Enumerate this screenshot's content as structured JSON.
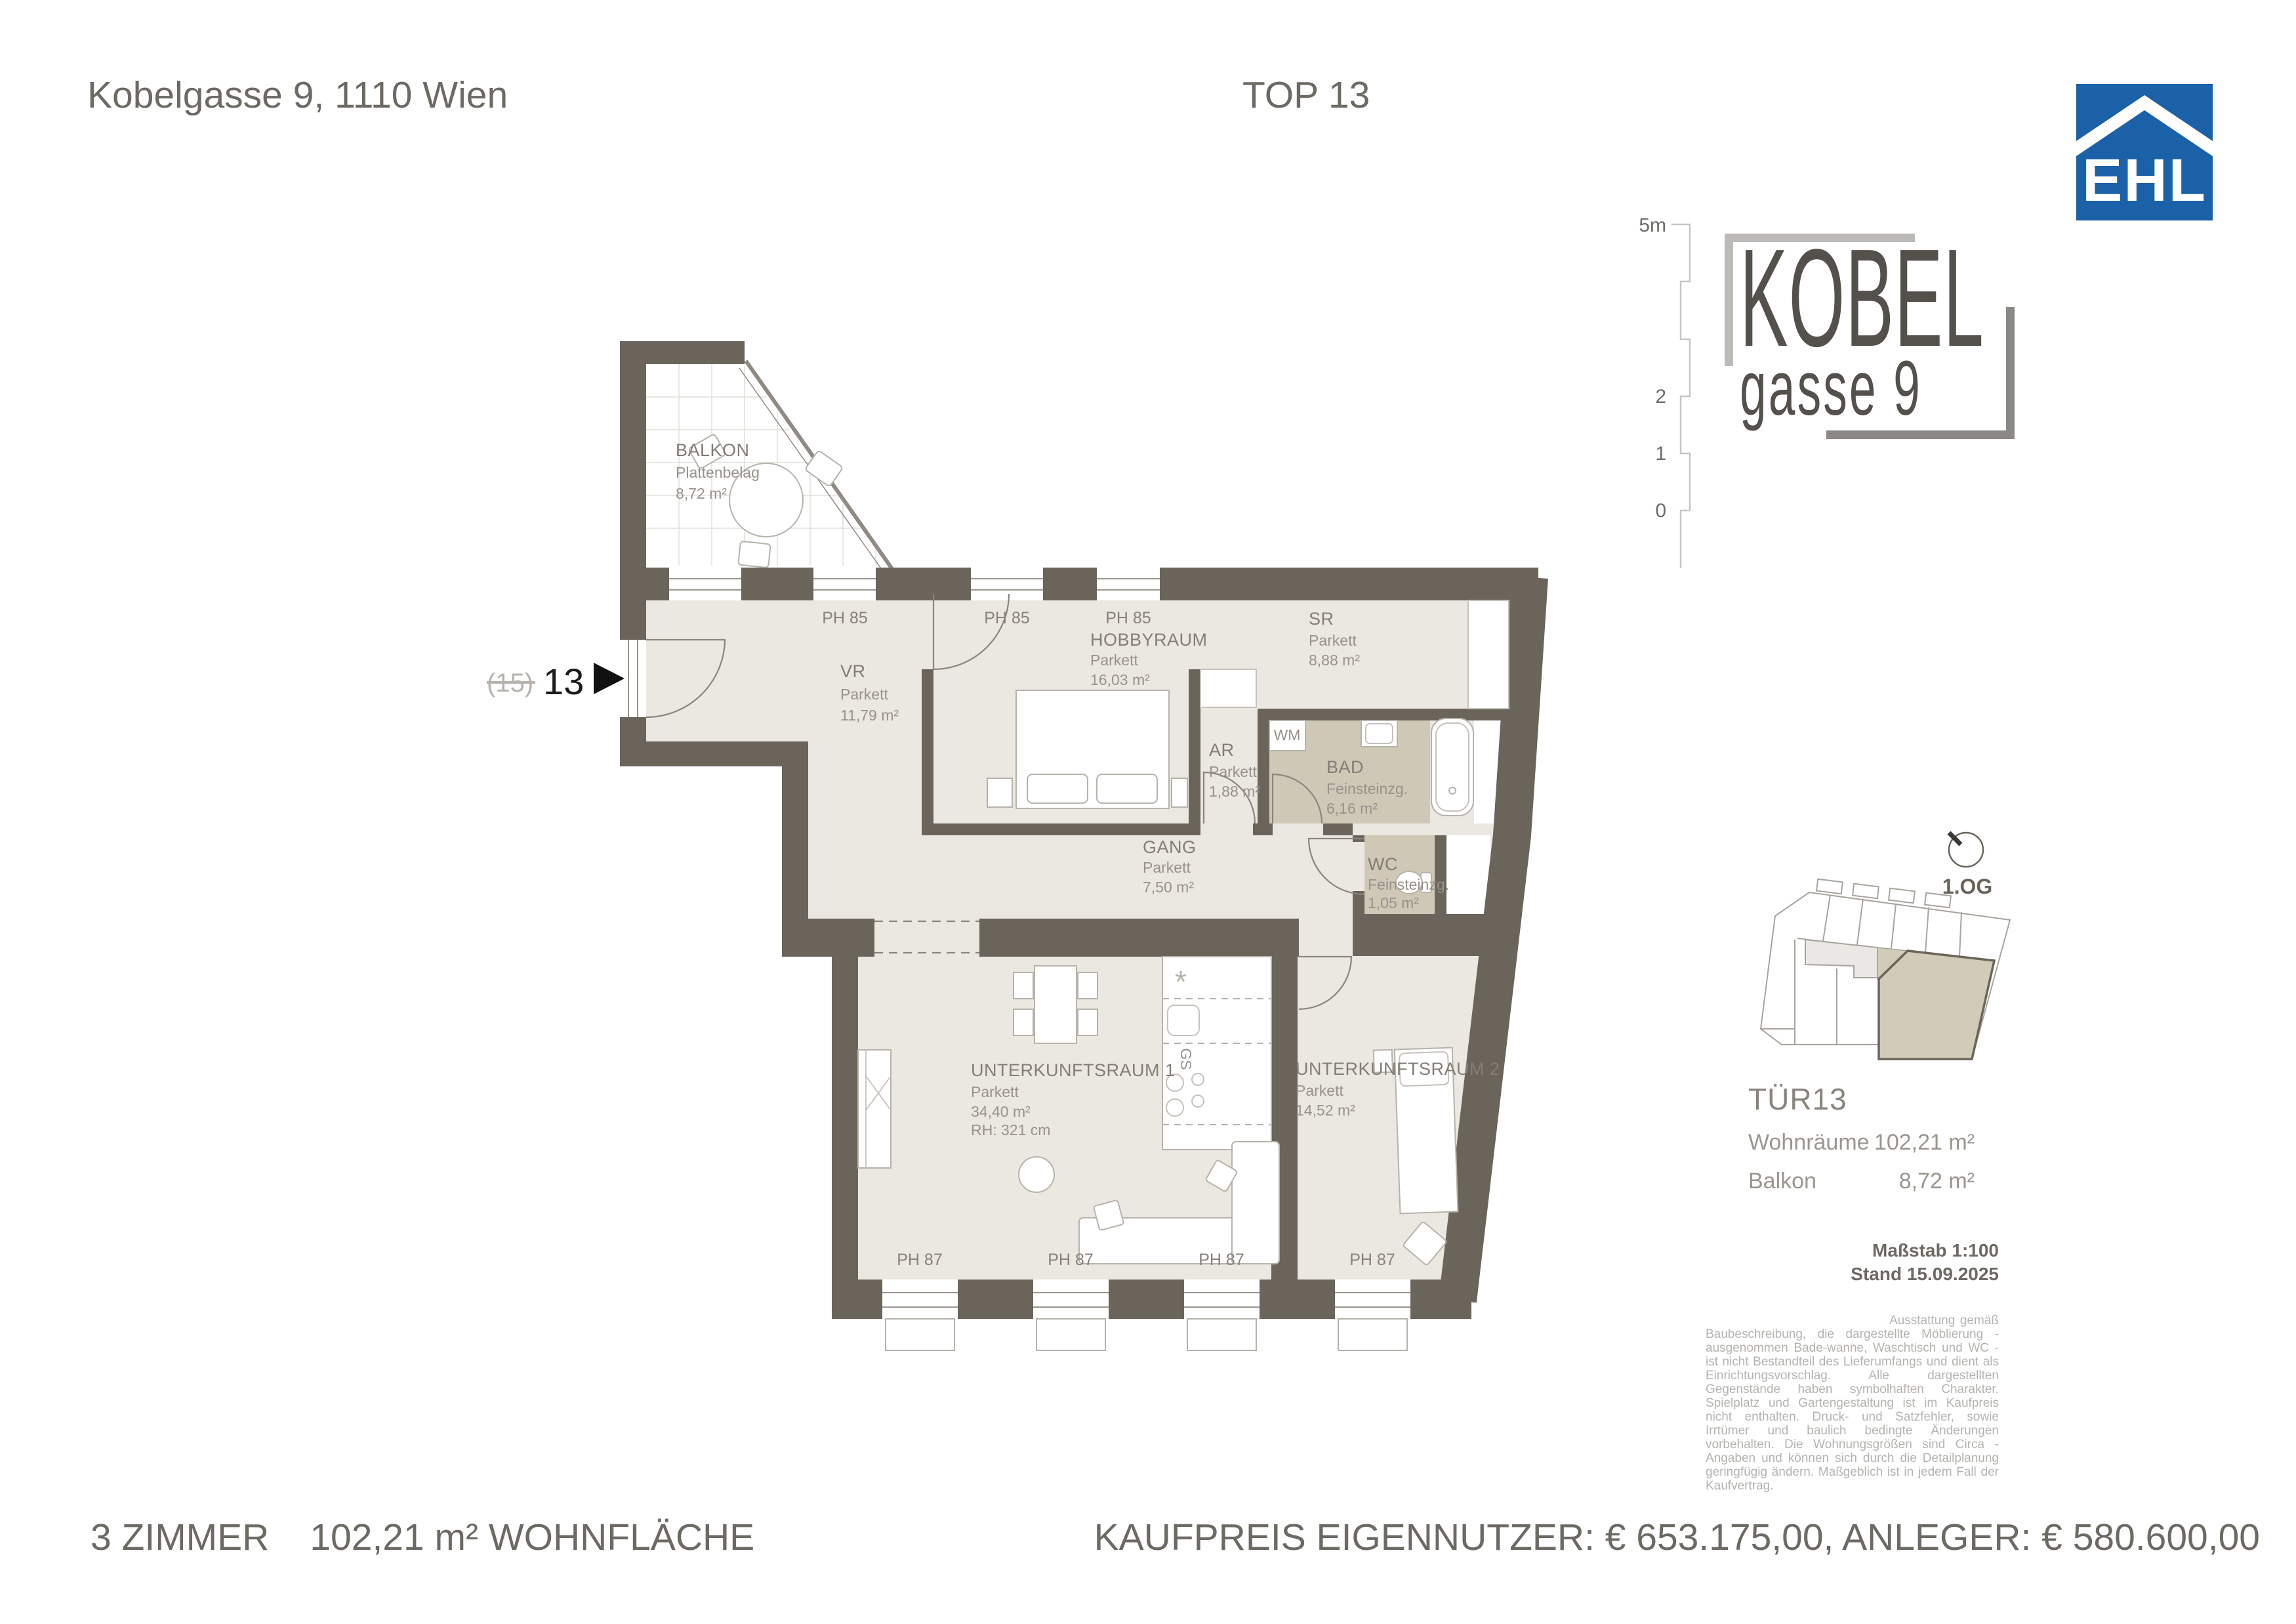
{
  "header": {
    "address": "Kobelgasse 9, 1110 Wien",
    "unit": "TOP 13"
  },
  "logo_ehl": {
    "text": "EHL",
    "blue": "#1b61a8"
  },
  "logo_kobel": {
    "line1": "KOBEL",
    "line2": "gasse 9"
  },
  "scalebar": {
    "top_label": "5m",
    "mid_labels": [
      "2",
      "1",
      "0"
    ]
  },
  "entrance": {
    "previous": "(15)",
    "current": "13"
  },
  "rooms": {
    "balkon": {
      "name": "BALKON",
      "finish": "Plattenbelag",
      "area": "8,72 m²"
    },
    "vr": {
      "name": "VR",
      "finish": "Parkett",
      "area": "11,79 m²"
    },
    "hobbyraum": {
      "name": "HOBBYRAUM",
      "finish": "Parkett",
      "area": "16,03 m²"
    },
    "sr": {
      "name": "SR",
      "finish": "Parkett",
      "area": "8,88 m²"
    },
    "ar": {
      "name": "AR",
      "finish": "Parkett",
      "area": "1,88 m²"
    },
    "bad": {
      "name": "BAD",
      "finish": "Feinsteinzg.",
      "area": "6,16 m²"
    },
    "wc": {
      "name": "WC",
      "finish": "Feinsteinzg.",
      "area": "1,05 m²"
    },
    "gang": {
      "name": "GANG",
      "finish": "Parkett",
      "area": "7,50 m²"
    },
    "ur1": {
      "name": "UNTERKUNFTSRAUM 1",
      "finish": "Parkett",
      "area": "34,40 m²",
      "rh": "RH: 321 cm"
    },
    "ur2": {
      "name": "UNTERKUNFTSRAUM 2",
      "finish": "Parkett",
      "area": "14,52 m²"
    }
  },
  "wall_labels": {
    "ph85": [
      "PH 85",
      "PH 85",
      "PH 85"
    ],
    "ph87": [
      "PH 87",
      "PH 87",
      "PH 87",
      "PH 87"
    ]
  },
  "appliances": {
    "wm": "WM",
    "gs": "GS",
    "freezer": "*"
  },
  "keyplan": {
    "floor": "1.OG",
    "unit": "TÜR13",
    "rows": [
      {
        "label": "Wohnräume",
        "value": "102,21 m²"
      },
      {
        "label": "Balkon",
        "value": "8,72 m²"
      }
    ],
    "scale_note": "Maßstab 1:100",
    "date_note": "Stand 15.09.2025"
  },
  "disclaimer": "Ausstattung gemäß Baubeschreibung, die dargestellte Möblierung - ausgenommen Bade-wanne, Waschtisch und WC - ist nicht Bestandteil des Lieferumfangs und dient als Einrichtungsvorschlag. Alle dargestellten Gegenstände haben symbolhaften Charakter. Spielplatz und Gartengestaltung ist im Kaufpreis nicht enthalten. Druck- und Satzfehler, sowie Irrtümer und baulich bedingte Änderungen vorbehalten. Die Wohnungsgrößen sind Circa - Angaben und können sich durch die Detailplanung geringfügig ändern. Maßgeblich ist in jedem Fall der Kaufvertrag.",
  "footer": {
    "rooms_label": "3 ZIMMER",
    "area_label": "102,21 m² WOHNFLÄCHE",
    "price_line": "KAUFPREIS EIGENNUTZER: € 653.175,00, ANLEGER: € 580.600,00"
  },
  "colors": {
    "wall": "#6b645b",
    "floor": "#ebe8e1",
    "wet_floor": "#cfc8b6",
    "label_gray": "#87827b",
    "ehl_blue": "#1b61a8"
  }
}
